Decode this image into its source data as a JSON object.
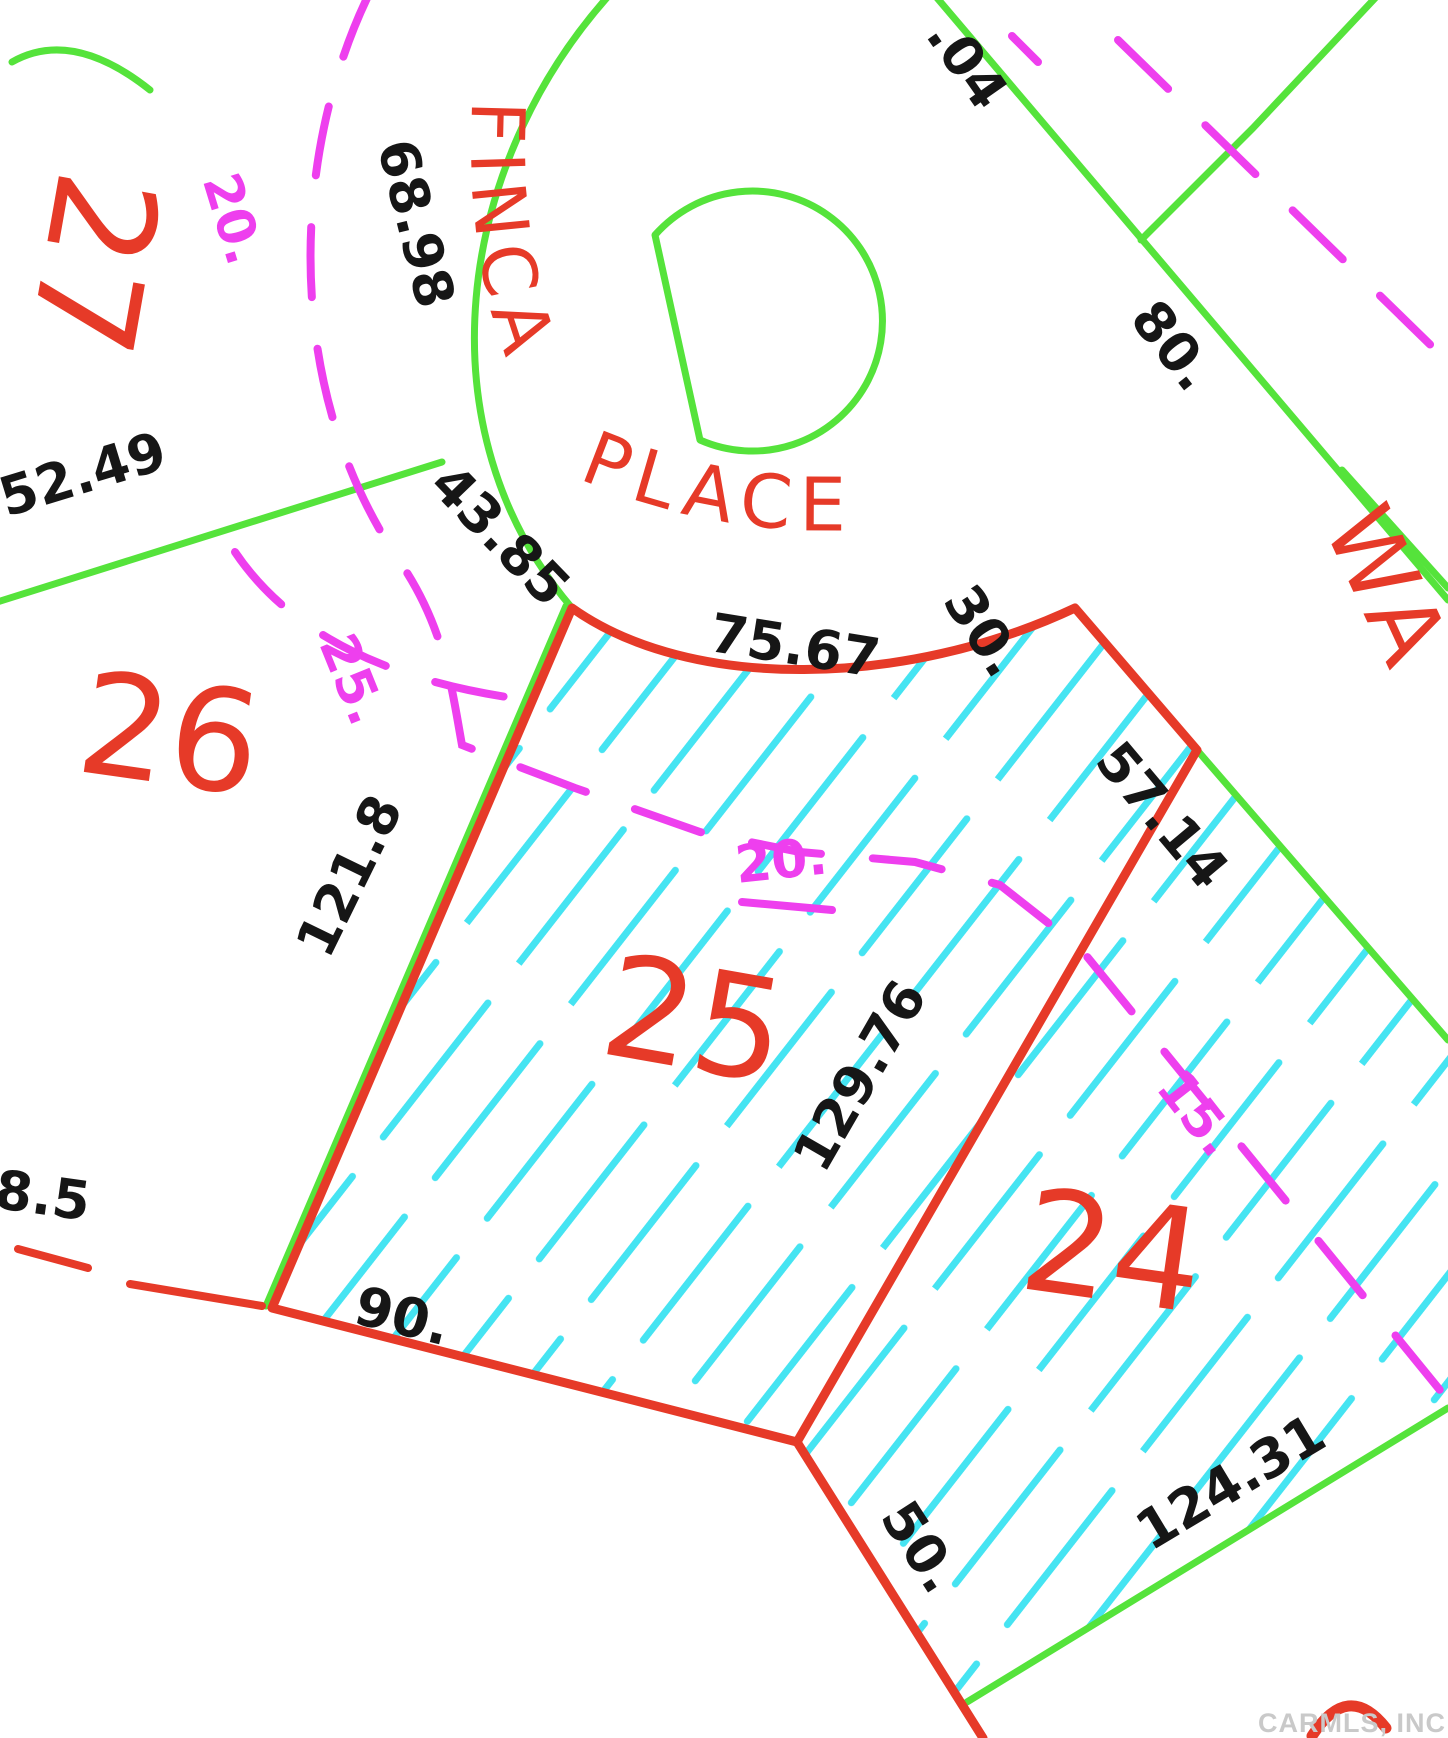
{
  "title": "Plat map detail - Finca Place cul-de-sac lots",
  "streets": {
    "finca": "FINCA",
    "place": "PLACE",
    "way": "WA"
  },
  "lots": {
    "lot24": "24",
    "lot25": "25",
    "lot26": "26",
    "lot27": "27"
  },
  "dimensions": {
    "d6898": "68.98",
    "d5249": "52.49",
    "d4385": "43.85",
    "d7567": "75.67",
    "d30": "30.",
    "d04": ".04",
    "d80": "80.",
    "d5714": "57.14",
    "d1218": "121.8",
    "d12976": "129.76",
    "d85": "8.5",
    "d90": "90.",
    "d50": "50.",
    "d12431": "124.31"
  },
  "setbacks": {
    "s20_left": "20.",
    "s25_left": "25.",
    "s20_mid": "20.",
    "s15_right": "15."
  },
  "watermark": "CARMLS, INC",
  "colors": {
    "red": "#e63a28",
    "green": "#55e33b",
    "cyan": "#45e4f2",
    "magenta": "#ee3fee",
    "black": "#161616",
    "watermark": "#c9c9c9"
  }
}
